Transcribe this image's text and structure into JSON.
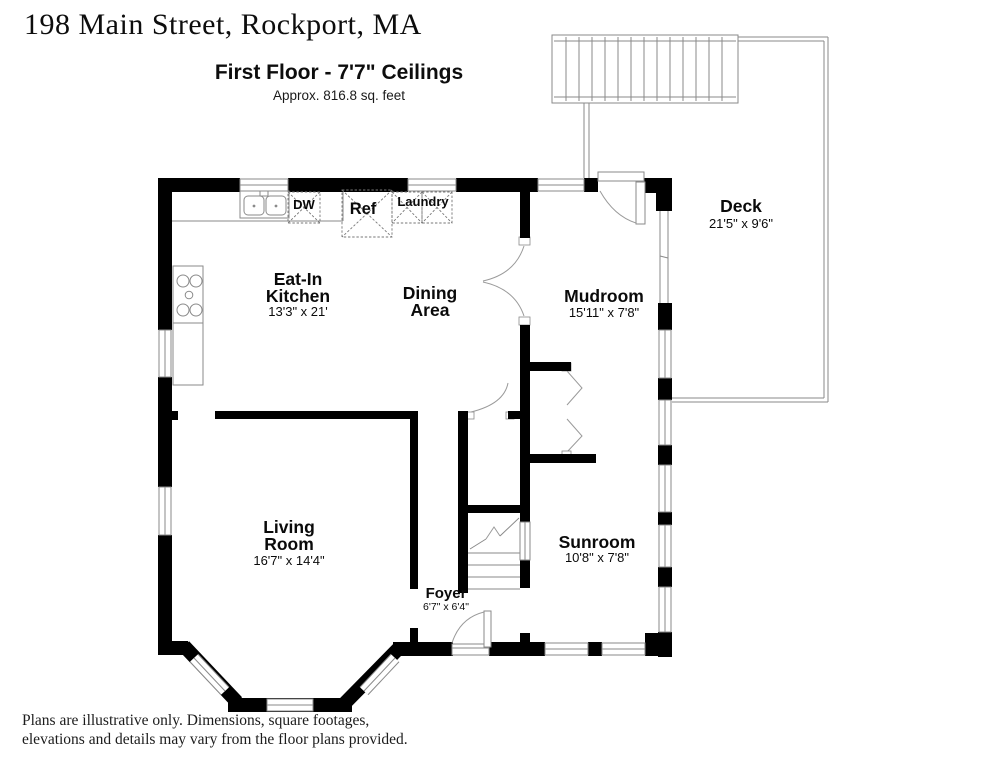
{
  "header": {
    "address": "198 Main Street, Rockport, MA",
    "floor_title": "First Floor - 7'7\" Ceilings",
    "floor_area": "Approx. 816.8 sq. feet"
  },
  "rooms": {
    "kitchen": {
      "name1": "Eat-In",
      "name2": "Kitchen",
      "dims": "13'3\" x 21'"
    },
    "dining": {
      "name1": "Dining",
      "name2": "Area"
    },
    "mudroom": {
      "name": "Mudroom",
      "dims": "15'11\" x 7'8\""
    },
    "deck": {
      "name": "Deck",
      "dims": "21'5\" x 9'6\""
    },
    "living": {
      "name1": "Living",
      "name2": "Room",
      "dims": "16'7\" x 14'4\""
    },
    "sunroom": {
      "name": "Sunroom",
      "dims": "10'8\" x 7'8\""
    },
    "foyer": {
      "name": "Foyer",
      "dims": "6'7\" x 6'4\""
    }
  },
  "fixtures": {
    "dishwasher": "DW",
    "refrigerator": "Ref",
    "laundry": "Laundry"
  },
  "footer": {
    "line1": "Plans are illustrative only. Dimensions, square footages,",
    "line2": "elevations and details may vary from the floor plans provided."
  },
  "colors": {
    "wall": "#000000",
    "thin_line": "#8a8a8a",
    "text": "#111111"
  }
}
